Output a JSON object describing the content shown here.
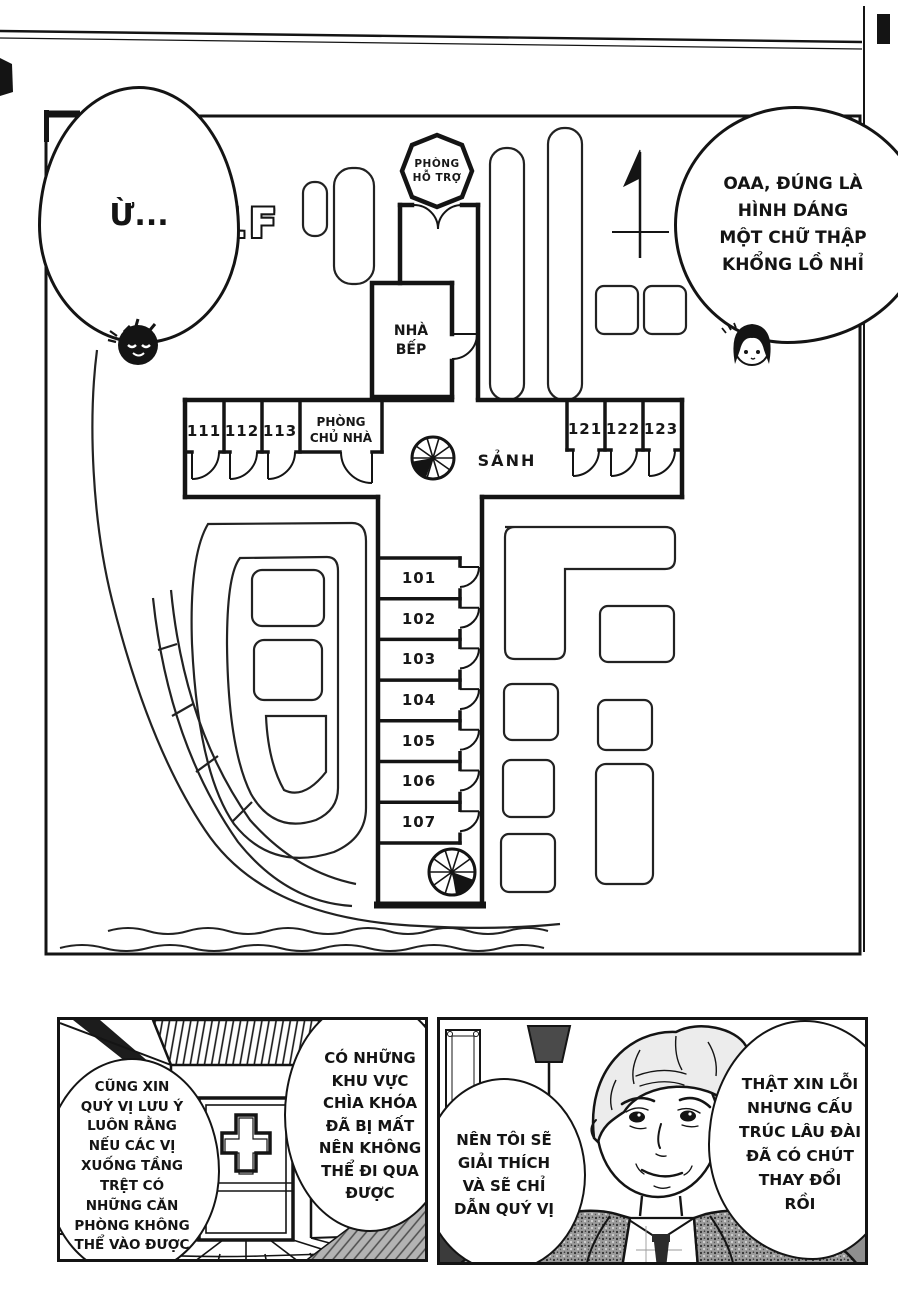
{
  "colors": {
    "ink": "#141414",
    "paper": "#ffffff"
  },
  "page": {
    "floor_label": "1F"
  },
  "speech": {
    "agree": "Ừ...",
    "cross_shape": "OAA, ĐÚNG LÀ\nHÌNH DÁNG\nMỘT CHỮ THẬP\nKHỔNG LỒ NHỈ",
    "note_rooms": "CŨNG XIN\nQUÝ VỊ LƯU Ý\nLUÔN RẰNG\nNẾU CÁC VỊ\nXUỐNG TẦNG\nTRỆT CÓ\nNHỮNG CĂN\nPHÒNG KHÔNG\nTHỂ VÀO ĐƯỢC",
    "lost_keys": "CÓ NHỮNG\nKHU VỰC\nCHÌA KHÓA\nĐÃ BỊ MẤT\nNÊN KHÔNG\nTHỂ ĐI QUA\nĐƯỢC",
    "guide": "NÊN TÔI SẼ\nGIẢI THÍCH\nVÀ SẼ CHỈ\nDẪN QUÝ VỊ",
    "apology": "THẬT XIN LỖI\nNHƯNG CẤU\nTRÚC LÂU ĐÀI\nĐÃ CÓ CHÚT\nTHAY ĐỔI\nRỒI"
  },
  "floorplan": {
    "support_room": "PHÒNG\nHỖ TRỢ",
    "kitchen": "NHÀ\nBẾP",
    "owner_room": "PHÒNG\nCHỦ NHÀ",
    "hall": "SẢNH",
    "west_rooms": [
      "111",
      "112",
      "113"
    ],
    "east_rooms": [
      "121",
      "122",
      "123"
    ],
    "south_rooms": [
      "101",
      "102",
      "103",
      "104",
      "105",
      "106",
      "107"
    ]
  }
}
